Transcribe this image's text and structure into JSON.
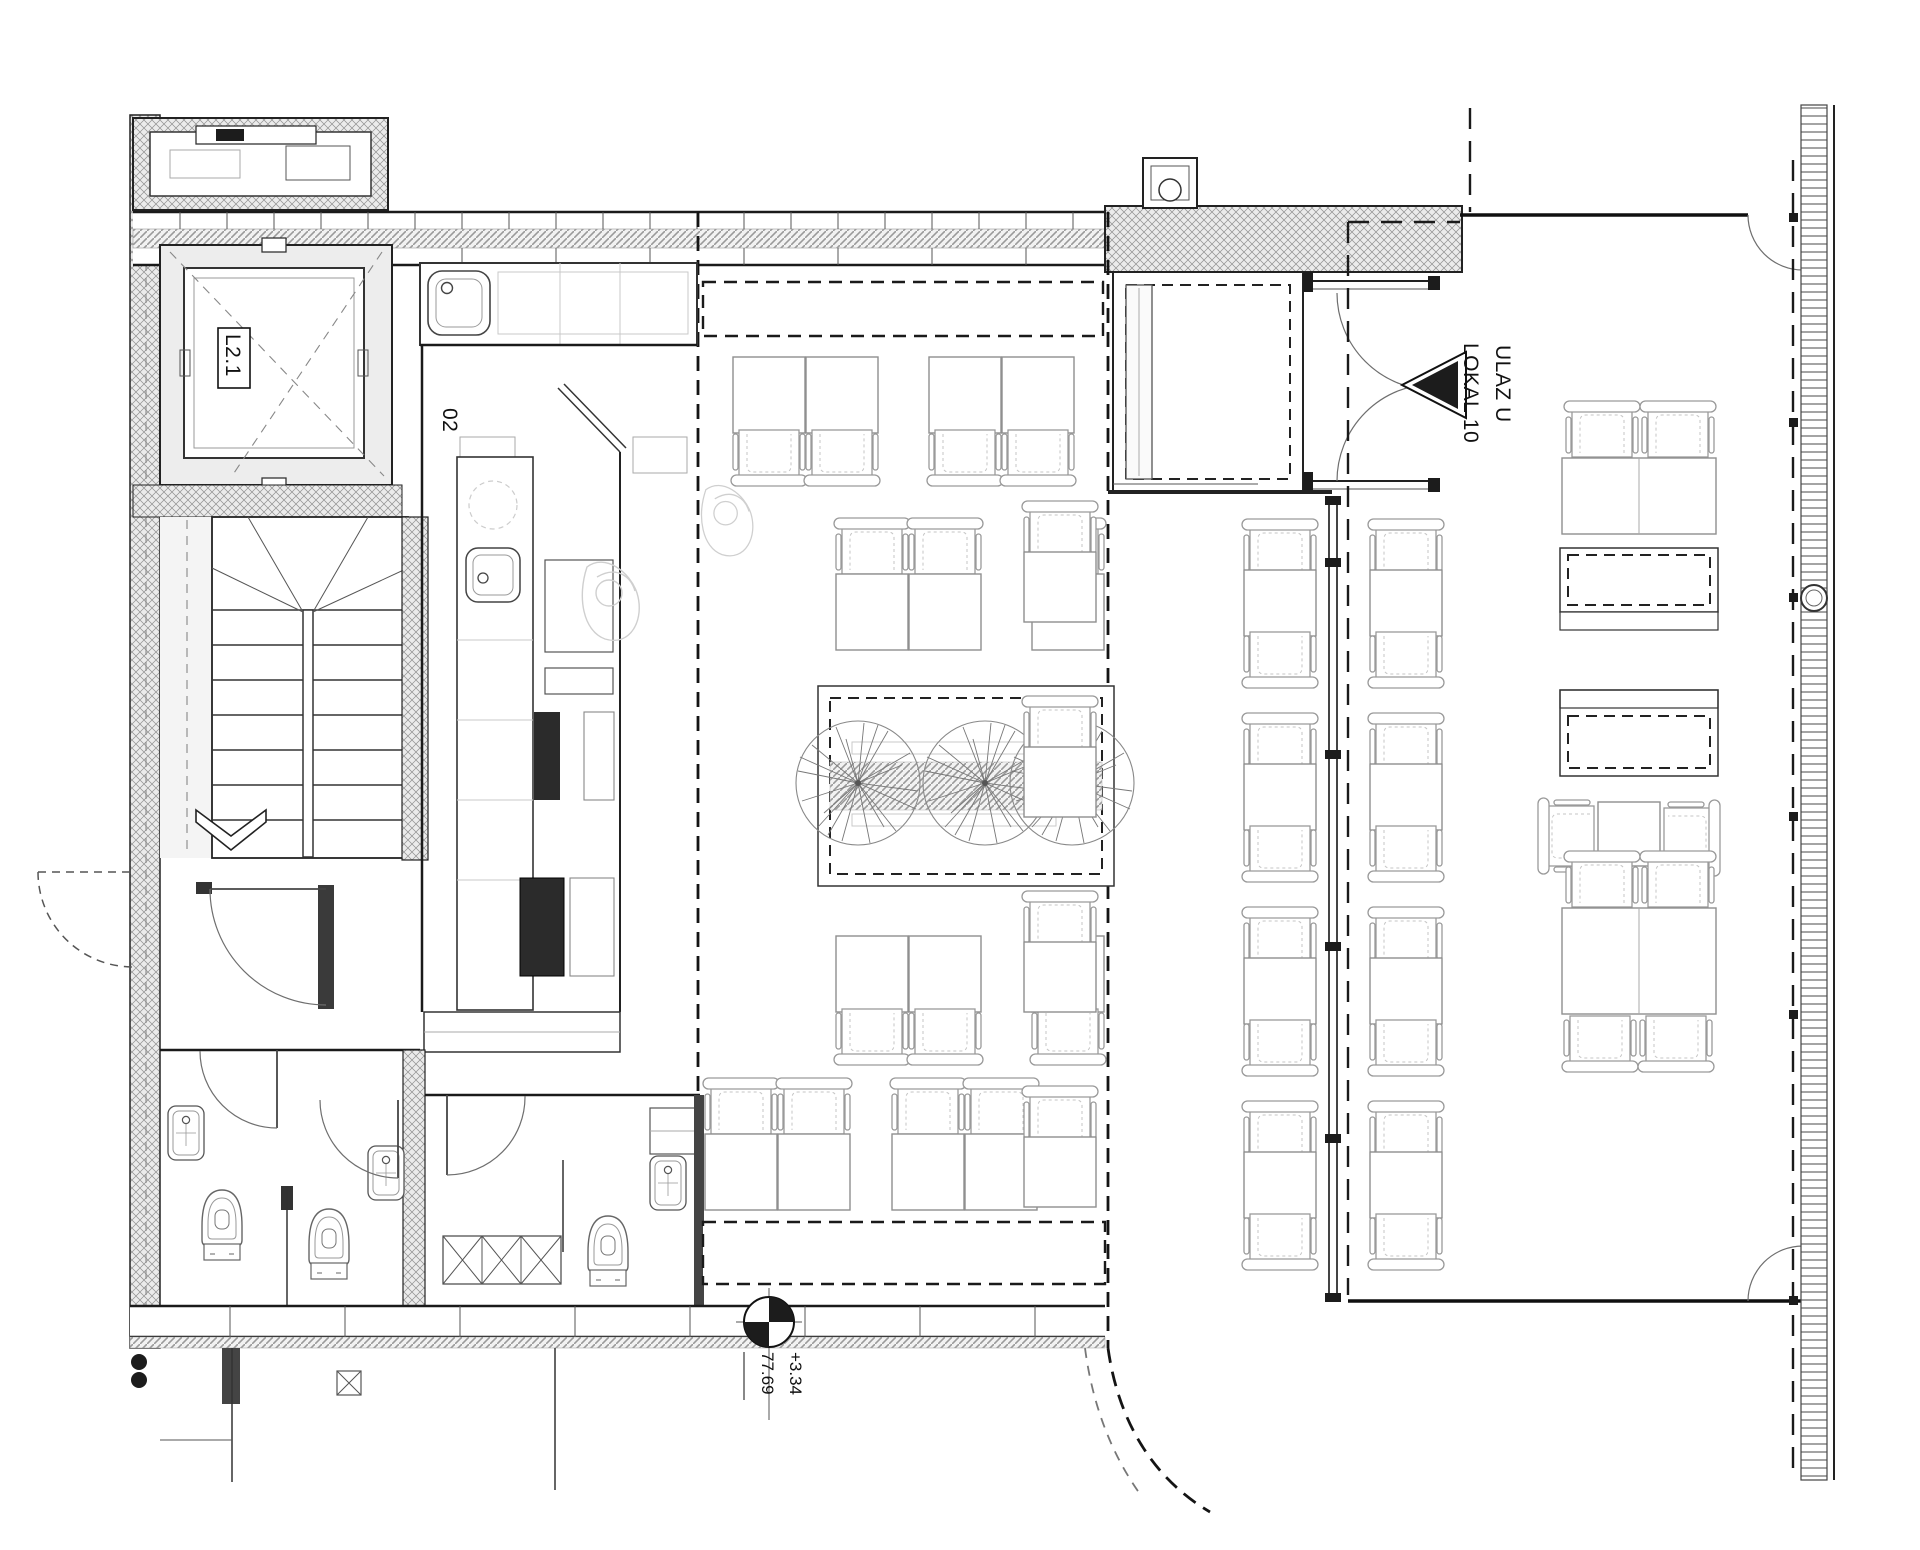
{
  "drawing": {
    "type": "architectural-floor-plan",
    "subject": "cafe-restaurant unit with kitchen, bar, WCs, stair core and terrace",
    "rooms": {
      "elevator_label": "L2.1",
      "service_room_number": "02"
    },
    "entrance": {
      "label_line1": "ULAZ U",
      "label_line2": "LOKAL 10"
    },
    "levels": {
      "relative": "+3.34",
      "absolute": "77.69"
    },
    "colors": {
      "paper": "#ffffff",
      "ink": "#1a1a1a",
      "medium_line": "#6b6b6b",
      "light_line": "#9a9a9a",
      "ghost_line": "#cfcfcf",
      "wall_hatch_fill": "#ebebeb"
    }
  }
}
